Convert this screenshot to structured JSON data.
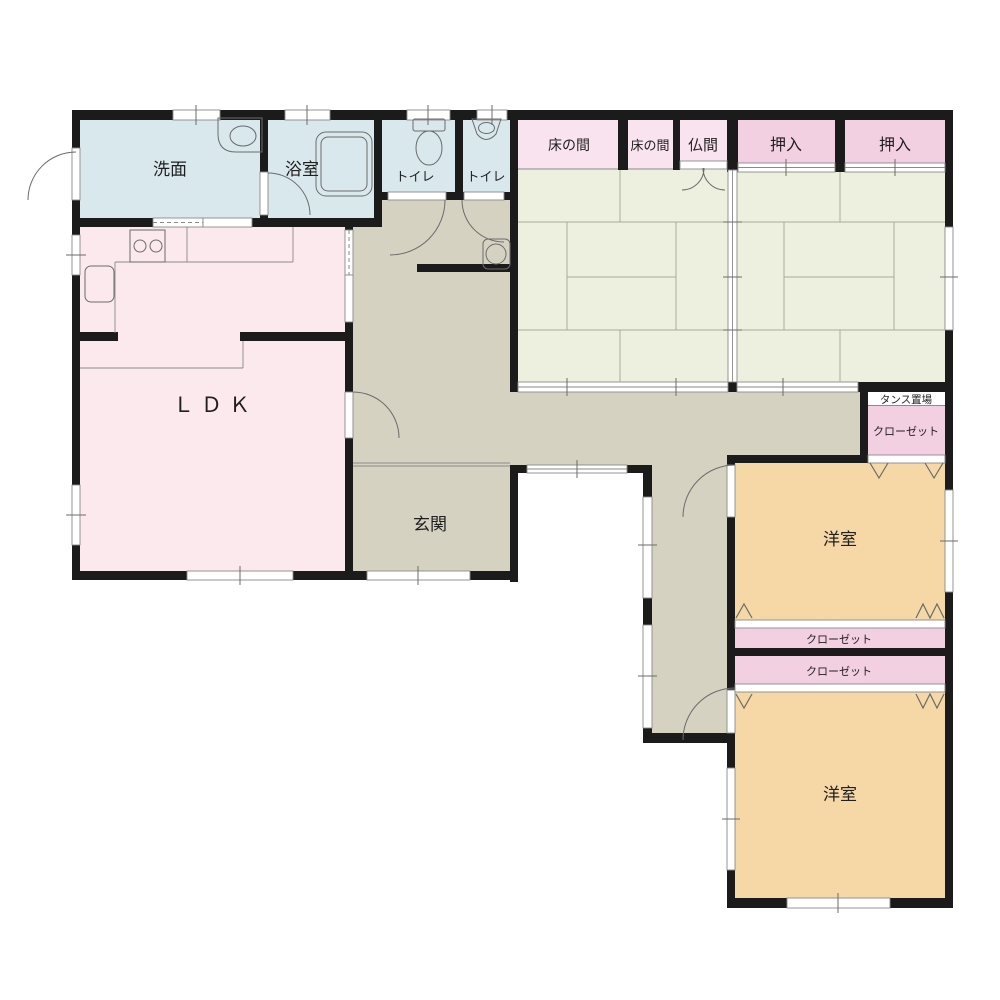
{
  "palette": {
    "wall": "#1b1b1b",
    "wet_room": "#d9e8ed",
    "ldk": "#fbe9ed",
    "tokonoma": "#f8e3ee",
    "oshiire": "#f3cfe2",
    "tatami": "#eef0df",
    "hall": "#d5d2c2",
    "western": "#f5d8a6",
    "tansu_floor": "#ffffff",
    "line": "#8a8a8a",
    "text": "#1f1f1f"
  },
  "rooms": {
    "senmen": {
      "label": "洗面"
    },
    "yokushitsu": {
      "label": "浴室"
    },
    "toilet1": {
      "label": "トイレ"
    },
    "toilet2": {
      "label": "トイレ"
    },
    "tokonoma1": {
      "label": "床の間"
    },
    "tokonoma2": {
      "label": "床の間"
    },
    "butsuma": {
      "label": "仏間"
    },
    "oshiire1": {
      "label": "押入"
    },
    "oshiire2": {
      "label": "押入"
    },
    "ldk": {
      "label": "ＬＤＫ"
    },
    "genkan": {
      "label": "玄関"
    },
    "tansu": {
      "label": "タンス置場"
    },
    "closet_upper": {
      "label": "クローゼット"
    },
    "closet_mid1": {
      "label": "クローゼット"
    },
    "closet_mid2": {
      "label": "クローゼット"
    },
    "western1": {
      "label": "洋室"
    },
    "western2": {
      "label": "洋室"
    }
  }
}
